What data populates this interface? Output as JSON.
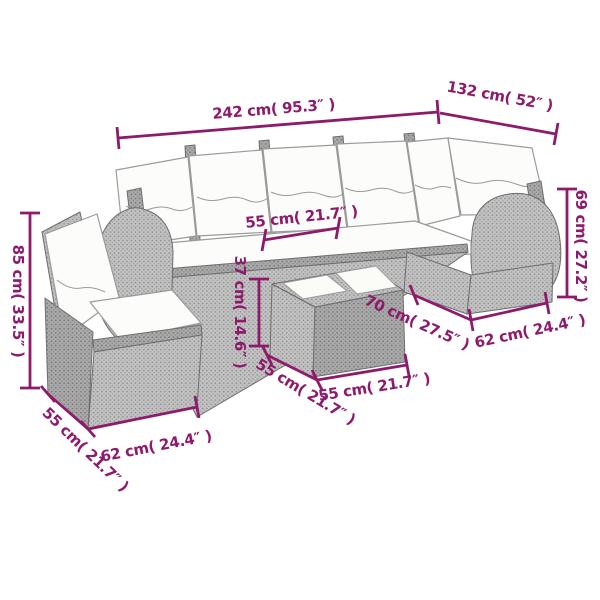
{
  "diagram": {
    "illustration": "rattan-corner-sofa-set-with-coffee-table",
    "accent_color": "#8e1a6b",
    "background_color": "#ffffff",
    "rattan_color": "#c3c3c3",
    "cushion_color": "#fcfcfa"
  },
  "labels": {
    "overall_width": "242 cm( 95.3″ )",
    "corner_section_width": "132 cm( 52″ )",
    "armrest_height": "69 cm( 27.2″ )",
    "backrest_height": "85 cm( 33.5″ )",
    "seat_depth": "55 cm( 21.7″ )",
    "table_height": "37 cm( 14.6″ )",
    "corner_seat_width": "70 cm( 27.5″ )",
    "right_module_width": "62 cm( 24.4″ )",
    "table_side_depth": "55 cm( 21.7″ )",
    "table_front_width": "55 cm( 21.7″ )",
    "left_module_depth": "55 cm( 21.7″ )",
    "left_module_width": "62 cm( 24.4″ )"
  }
}
